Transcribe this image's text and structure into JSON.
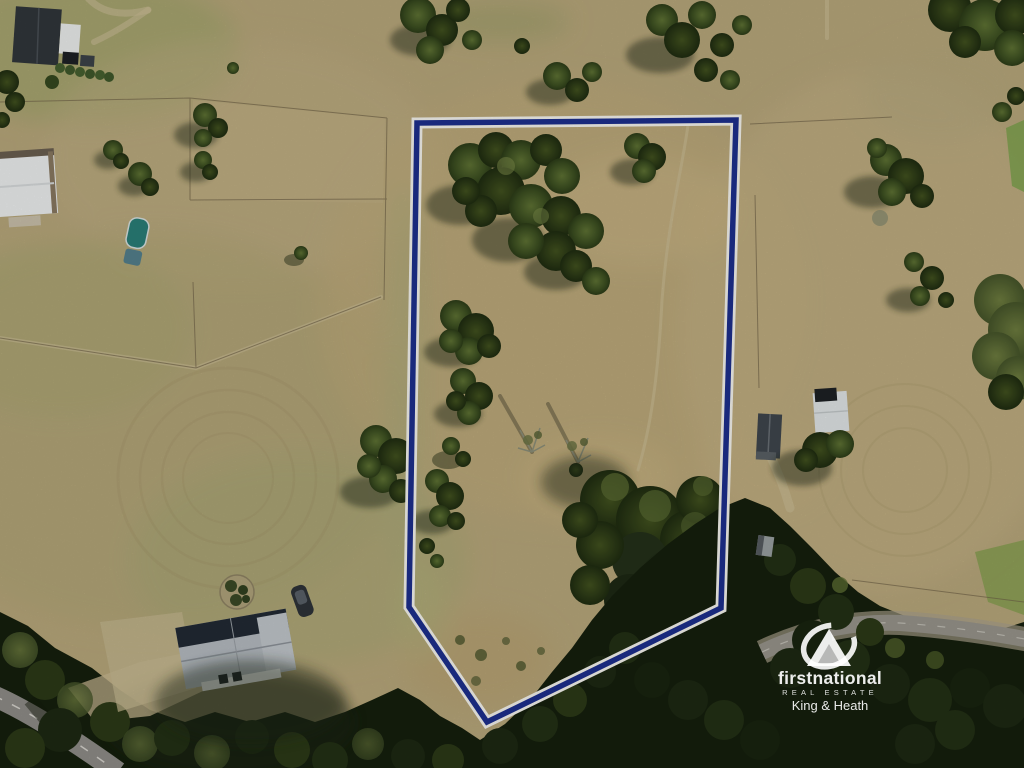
{
  "watermark": {
    "brand": "firstnational",
    "tagline": "REAL ESTATE",
    "agency": "King & Heath",
    "icon": "first-national-logo",
    "text_color": "#ffffff"
  },
  "boundary": {
    "points": "417,123 736,120 721,608 487,722 409,607",
    "line_color": "#1d2f8e",
    "outline_color": "#f6f5ef"
  },
  "colors": {
    "grass_tan": "#bcab7d",
    "grass_green": "#9aa468",
    "tree_dark_green": "#33431c",
    "forest_shadow": "#151f0d",
    "road_grey": "#98958c"
  }
}
